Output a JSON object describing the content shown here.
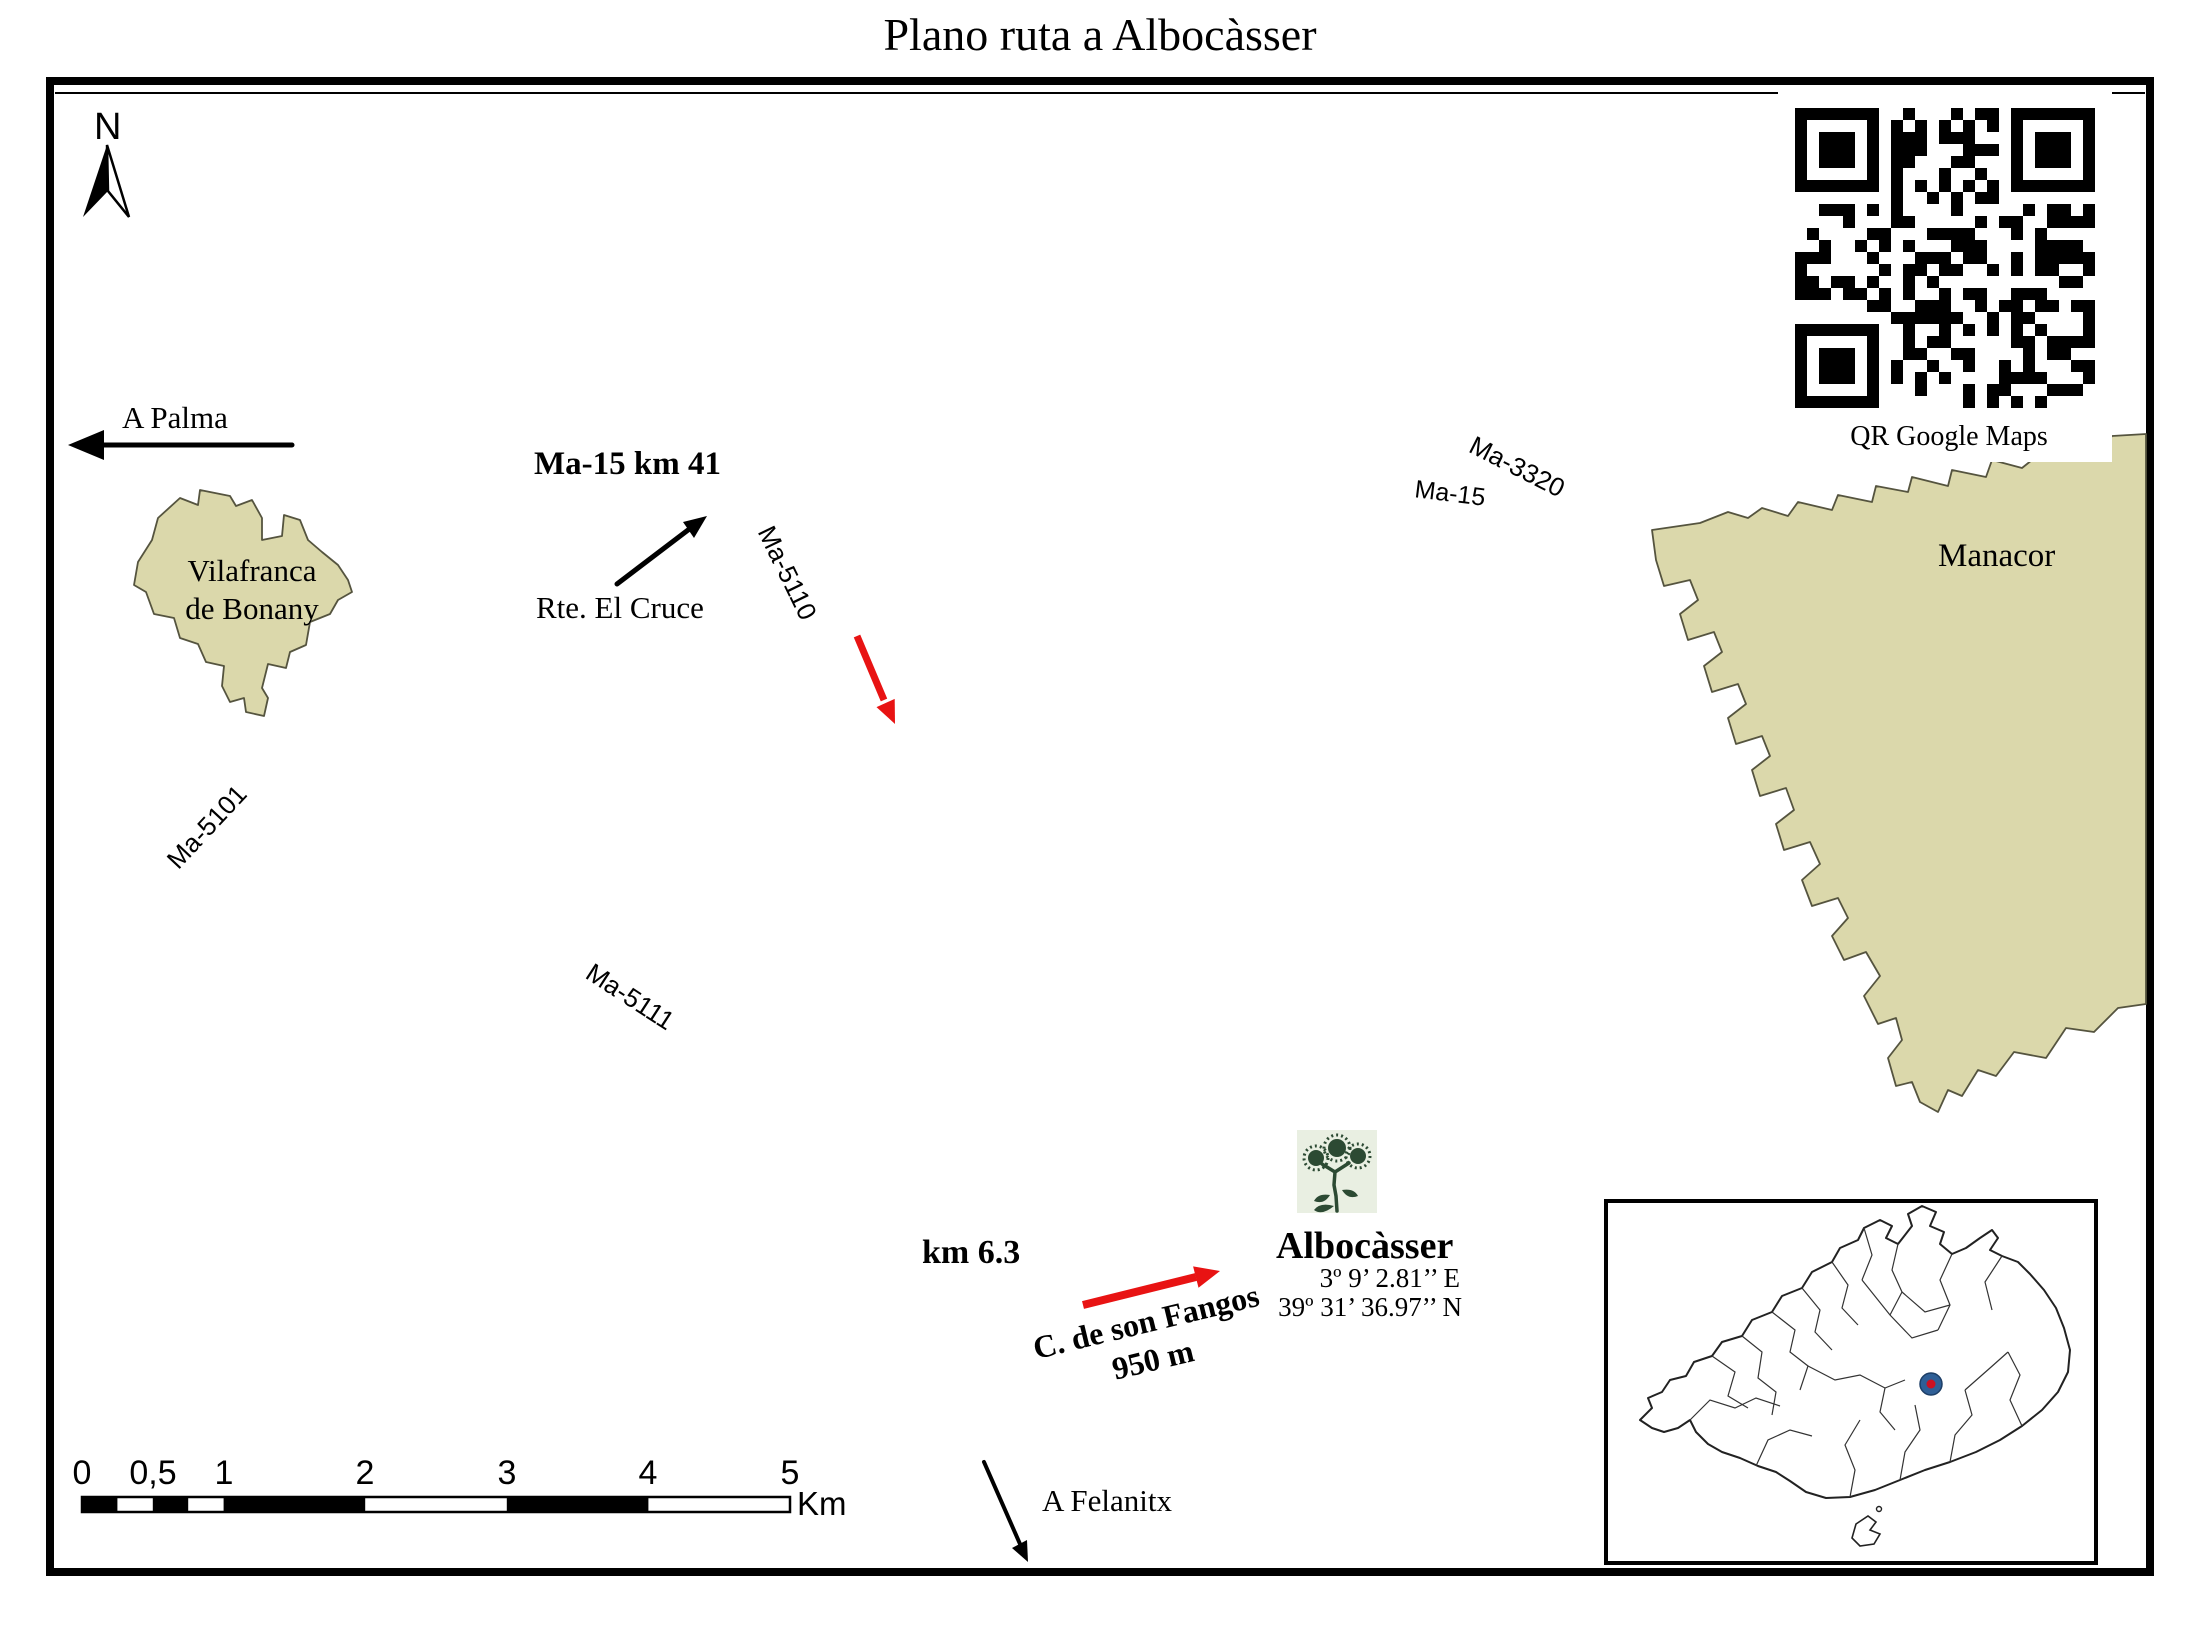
{
  "map": {
    "title": "Plano ruta a Albocàsser"
  },
  "compass": {
    "label": "N"
  },
  "destinations": {
    "palma": "A Palma",
    "felanitx": "A Felanitx"
  },
  "towns": {
    "vilafranca_line1": "Vilafranca",
    "vilafranca_line2": "de Bonany",
    "manacor": "Manacor",
    "albocasser": "Albocàsser"
  },
  "roads": {
    "ma15": "Ma-15",
    "ma15_km41": "Ma-15 km 41",
    "ma3320": "Ma-3320",
    "ma5101": "Ma-5101",
    "ma5110": "Ma-5110",
    "ma5111": "Ma-5111"
  },
  "poi": {
    "rte_el_cruce": "Rte. El Cruce",
    "km63": "km 6.3",
    "fangos_road": "C. de son Fangos",
    "fangos_dist": "950 m"
  },
  "coordinates": {
    "east": "3º 9’ 2.81’’ E",
    "north": "39º 31’ 36.97’’ N"
  },
  "qr": {
    "caption": "QR Google Maps"
  },
  "scalebar": {
    "ticks": [
      "0",
      "0,5",
      "1",
      "2",
      "3",
      "4",
      "5"
    ],
    "unit": "Km"
  },
  "colors": {
    "town_fill": "#dbd8ab",
    "town_stroke": "#55543f",
    "road": "#000000",
    "route_arrow": "#e81313",
    "inset_marker": "#2f5f96",
    "inset_marker_center": "#cc1122",
    "plant_green": "#2c4a33",
    "plant_bg": "#e9efe2"
  }
}
